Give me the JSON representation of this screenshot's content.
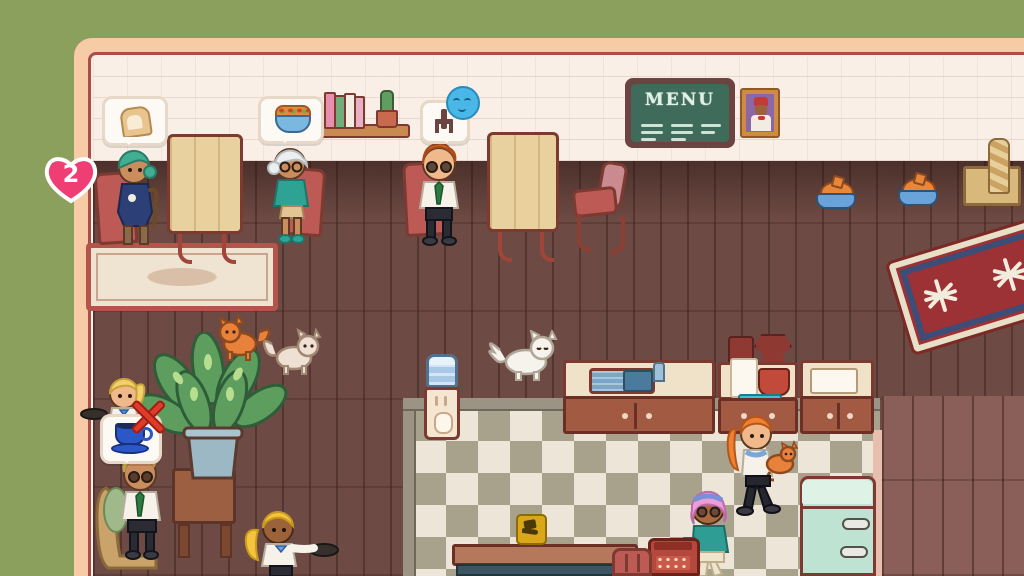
{
  "scene": {
    "name": "cat-cafe-dining-room",
    "background_color": "#8ca05e",
    "frame_color": "#f7cba5"
  },
  "hud": {
    "heart_badge": {
      "count": "2",
      "heart_color": "#ef3e74",
      "text_color": "#ffffff"
    }
  },
  "wall_decor": {
    "menu_board": {
      "title": "MENU",
      "board_color": "#3e6b5a",
      "frame_color": "#6b4340"
    },
    "portrait": {
      "subject": "person-with-red-fez",
      "background": "#8a68a5",
      "frame_color": "#cf8a44"
    },
    "bookshelf": {
      "books": [
        "pink",
        "green",
        "white",
        "pink"
      ],
      "top_item": "cactus-pot"
    }
  },
  "thought_bubbles": [
    {
      "owner": "customer-green-hair",
      "icon": "bread-slice-icon"
    },
    {
      "owner": "customer-white-hair",
      "icon": "salad-bowl-icon"
    },
    {
      "owner": "customer-orange-hair",
      "icon": "chair-icon",
      "mood": "relaxed-blue-face-icon"
    },
    {
      "owner": "waitress-front",
      "icon": "coffee-cup-icon",
      "status": "blocked-red-x-icon"
    }
  ],
  "characters": [
    {
      "id": "customer-green-hair",
      "desc": "seated, teal hair, navy dress, holding cane"
    },
    {
      "id": "customer-white-hair",
      "desc": "seated elder, glasses, teal cardigan"
    },
    {
      "id": "customer-orange-hair",
      "desc": "seated, glasses, white shirt, green tie"
    },
    {
      "id": "waitress-front",
      "desc": "blonde ponytail, holding tray"
    },
    {
      "id": "customer-blonde-sunglasses",
      "desc": "seated, white shirt, green tie"
    },
    {
      "id": "waitress-bottom",
      "desc": "dark skin, gold ponytail, holding tray"
    },
    {
      "id": "staff-ginger-cat-holder",
      "desc": "ginger ponytail, holding orange cat"
    },
    {
      "id": "customer-purple-hair",
      "desc": "pink bob, headband, teal jacket, teal bag"
    }
  ],
  "pets": [
    {
      "id": "orange-cat"
    },
    {
      "id": "cream-cat"
    },
    {
      "id": "white-fluffy-cat"
    },
    {
      "id": "held-orange-cat"
    }
  ],
  "furniture": [
    "wood-table-left",
    "wood-table-center",
    "red-chair-empty",
    "scratching-post",
    "pet-bowl-1",
    "pet-bowl-2",
    "sink-counter",
    "coffee-counter",
    "prep-counter",
    "mint-fridge",
    "water-cooler",
    "potted-plant",
    "side-table",
    "cash-register",
    "bottom-table",
    "bottom-red-chair",
    "rug-cream",
    "rug-red-blue"
  ],
  "indicators": {
    "serve_spot": "hand-serving-icon",
    "serve_spot_color": "#d9a718"
  }
}
